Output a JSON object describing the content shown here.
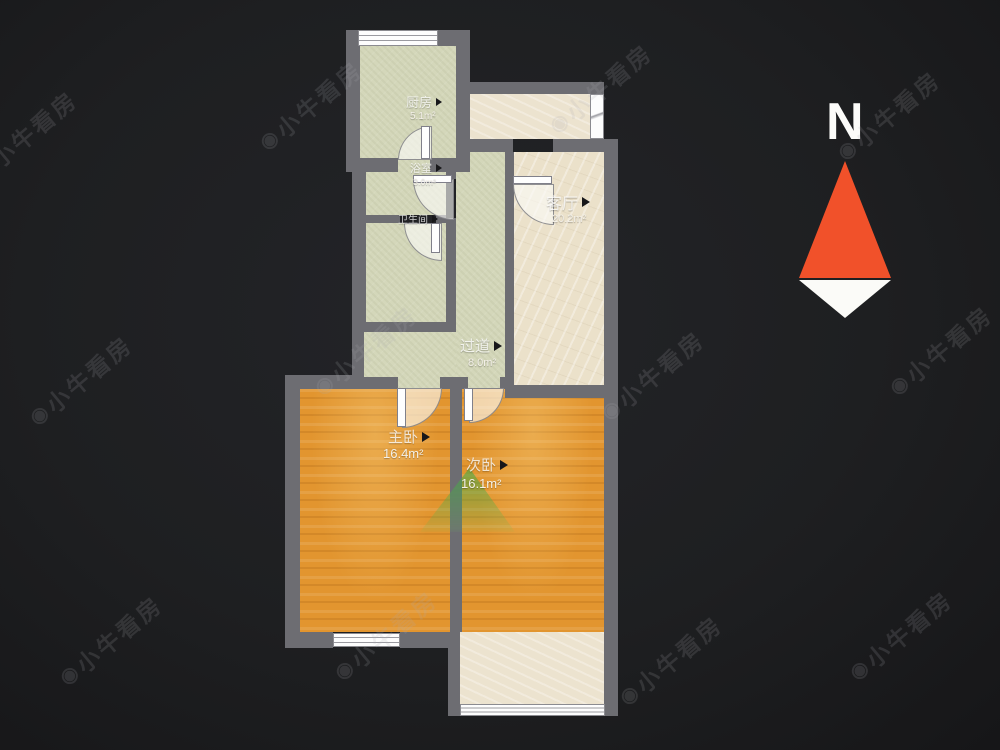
{
  "floorplan": {
    "rooms": [
      {
        "id": "kitchen",
        "name": "厨房",
        "area": "5.1m²"
      },
      {
        "id": "bath",
        "name": "浴室",
        "area": "3.0m²"
      },
      {
        "id": "toilet",
        "name": "卫生间",
        "area": ""
      },
      {
        "id": "living-room",
        "name": "客厅",
        "area": "20.2m²"
      },
      {
        "id": "hallway",
        "name": "过道",
        "area": "8.0m²"
      },
      {
        "id": "master-bedroom",
        "name": "主卧",
        "area": "16.4m²"
      },
      {
        "id": "second-bedroom",
        "name": "次卧",
        "area": "16.1m²"
      }
    ],
    "colors": {
      "wall": "#6d6d72",
      "floor_green": "#d4d7ba",
      "floor_beige": "#ece3cf",
      "floor_wood": "#e2952f",
      "background": "#1e1f21"
    }
  },
  "compass": {
    "label": "N",
    "needle_color": "#f1512a"
  },
  "watermark": {
    "text": "小牛看房",
    "logo_glyph": "◉"
  }
}
